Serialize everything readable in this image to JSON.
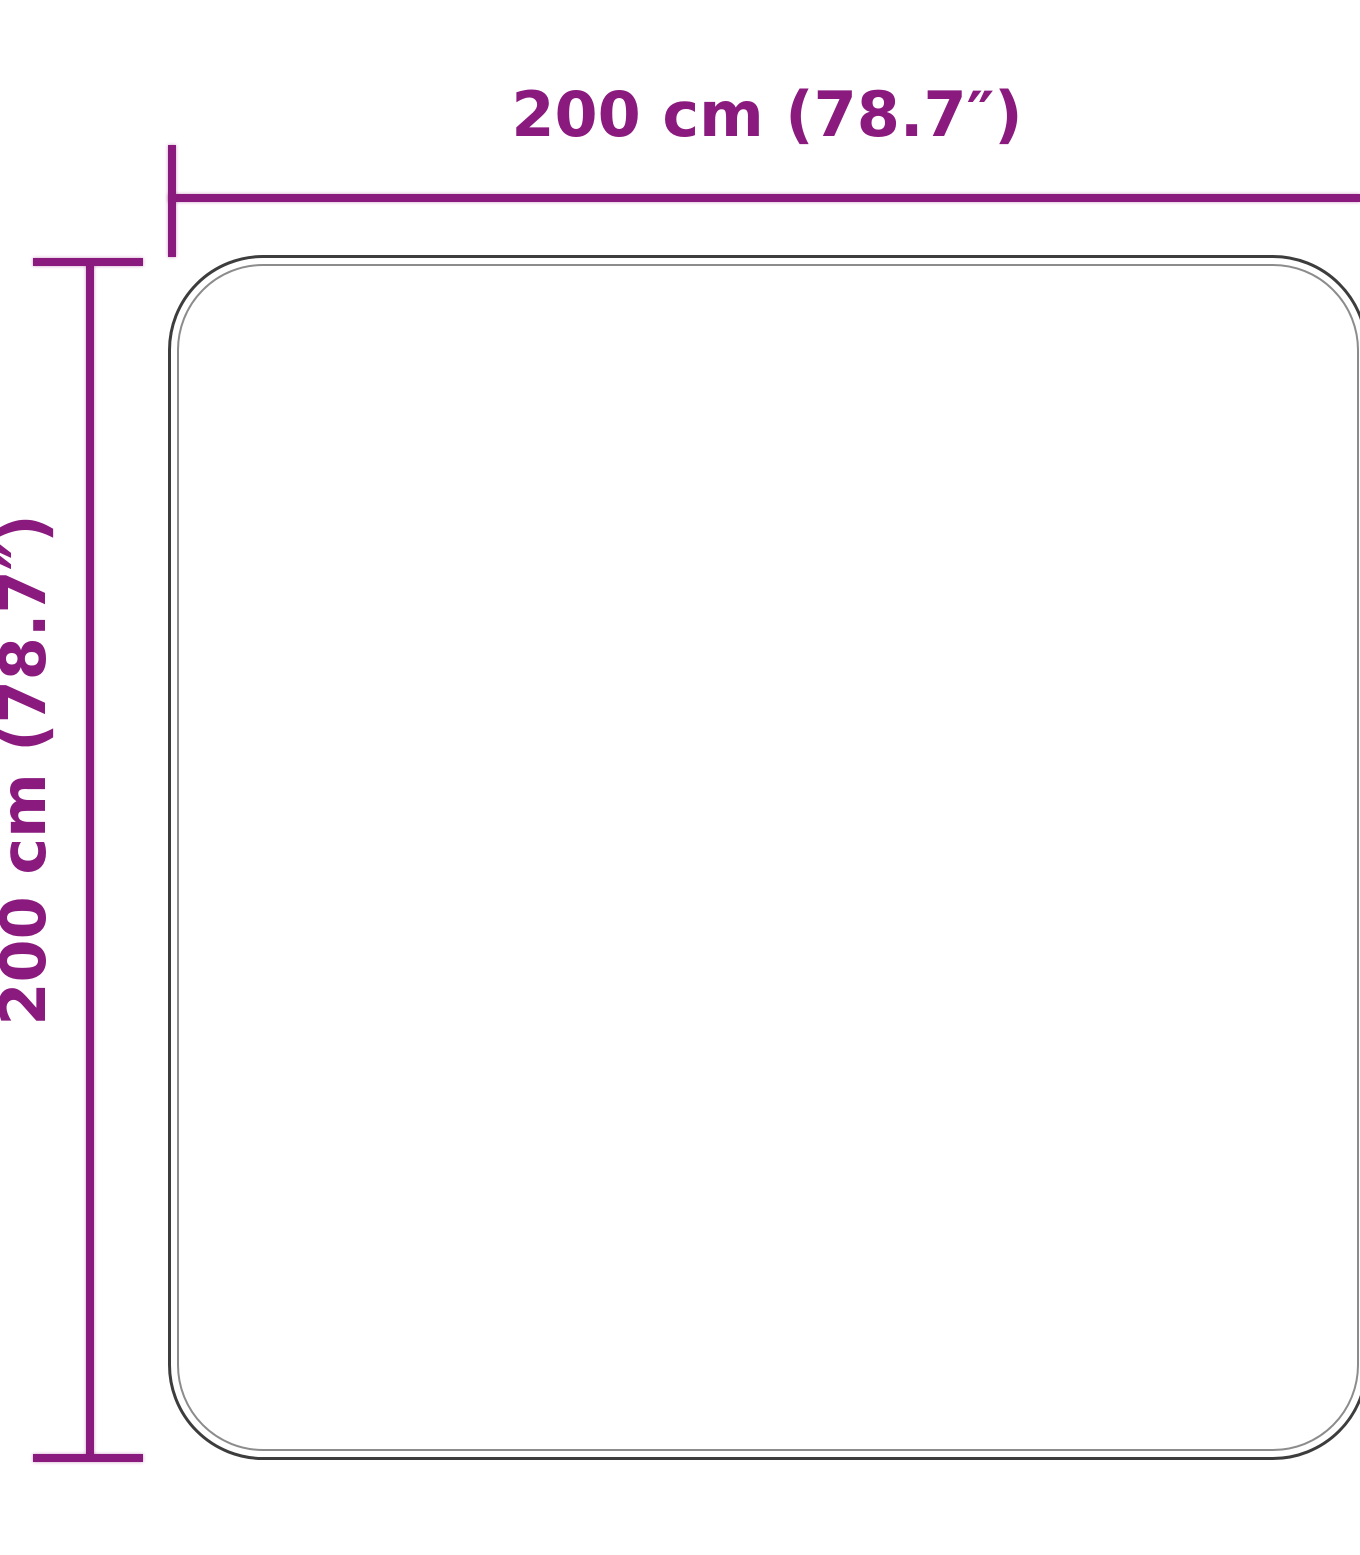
{
  "diagram": {
    "type": "product-dimension-diagram",
    "object": "rug-outline-rounded-square",
    "background_color": "#ffffff",
    "accent_color": "#8a1a7d",
    "outline_outer_color": "#3d3d3d",
    "outline_inner_color": "#8c8c8c",
    "dimensions": {
      "width": {
        "label": "200 cm (78.7″)"
      },
      "height": {
        "label": "200 cm (78.7″)"
      }
    }
  }
}
